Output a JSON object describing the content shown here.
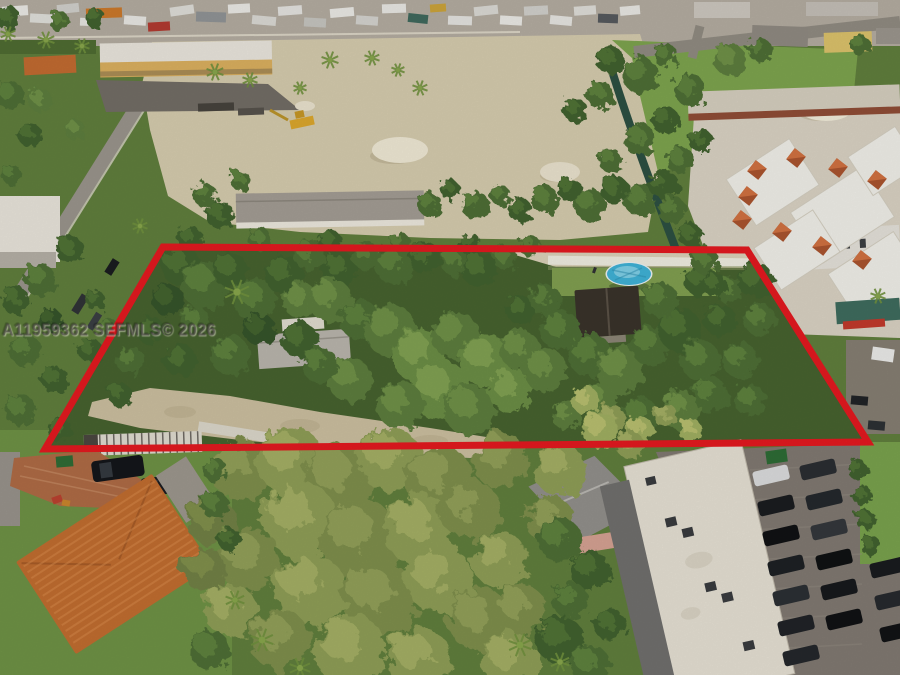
{
  "photo": {
    "kind": "aerial-drone-photograph",
    "subject": "wooded residential lot outlined in red"
  },
  "watermark": {
    "text": "A11959362 SEFMLS© 2026"
  },
  "boundary": {
    "points": "163,247 747,250 868,442 45,449",
    "color": "#e2191f",
    "stroke_width": 7
  },
  "scene": {
    "pool_color": "#3fb0d4",
    "sand_color": "#d3c9ac",
    "accent_roof_color": "#bf6c2f"
  }
}
